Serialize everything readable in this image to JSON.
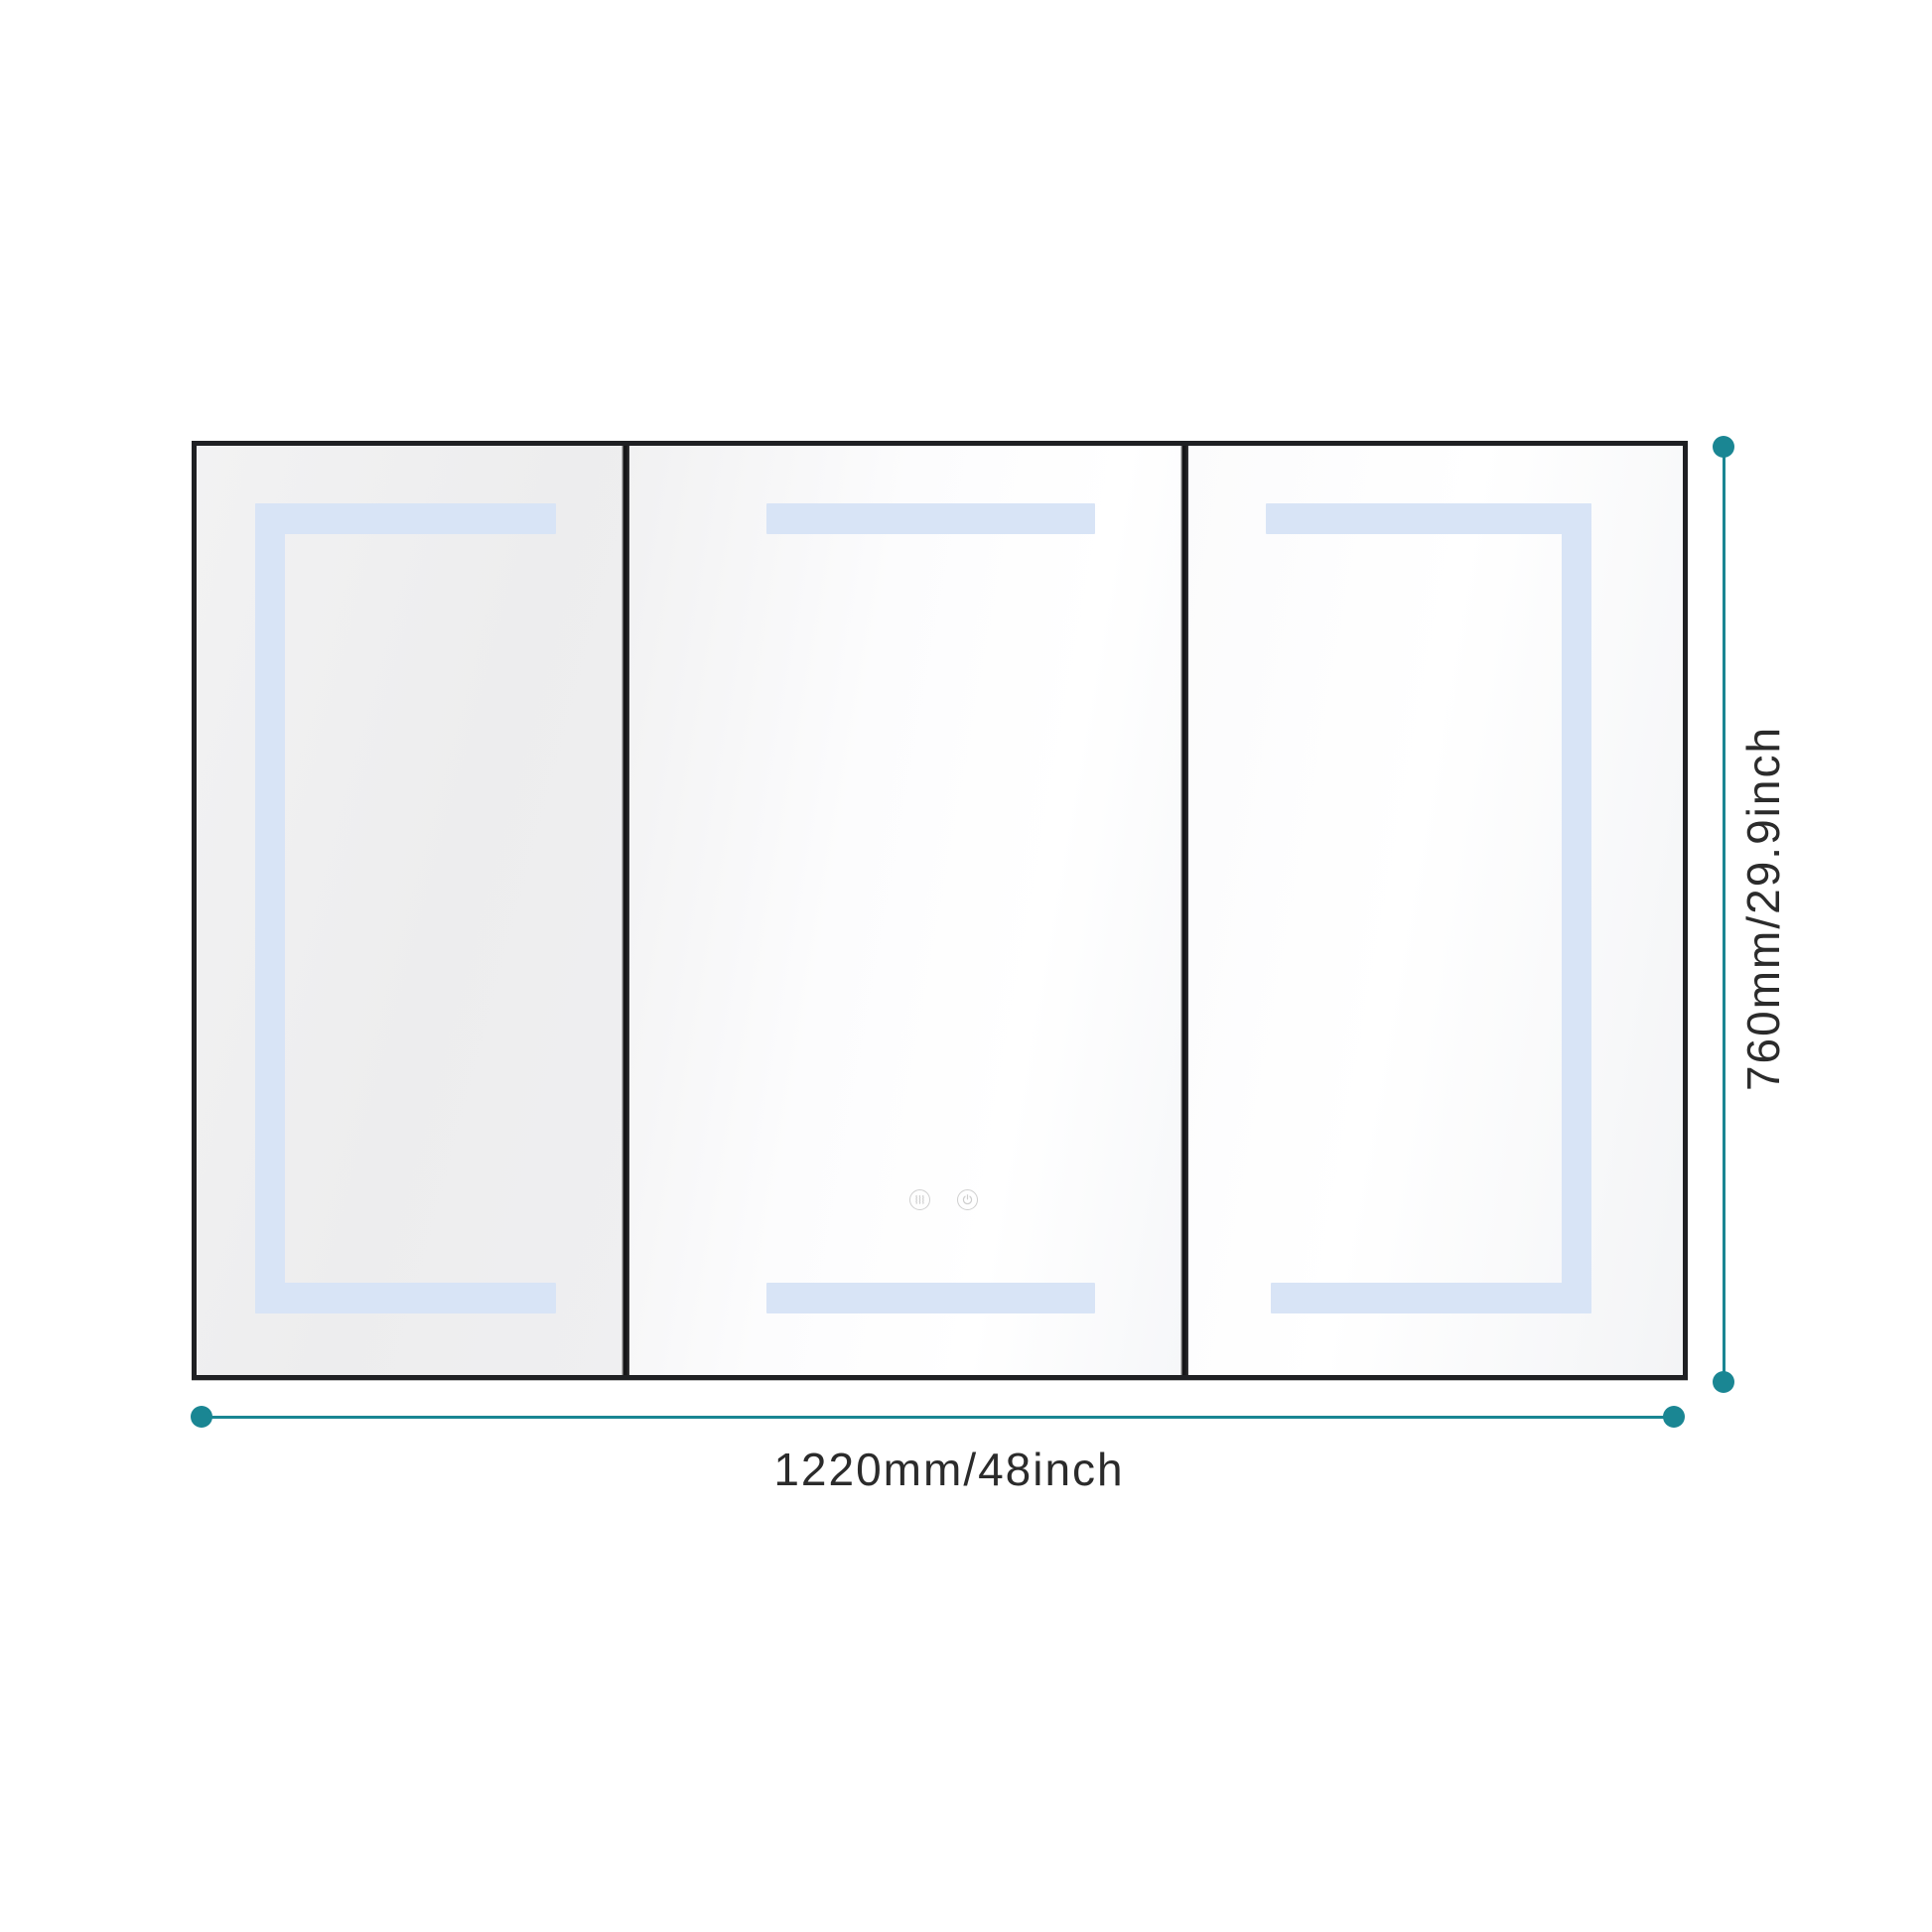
{
  "diagram": {
    "subject": "3-door LED mirror medicine cabinet - front dimension drawing",
    "panel_count": 3,
    "panels": [
      {
        "id": "left",
        "led_shape": "top-left-bottom frame"
      },
      {
        "id": "middle",
        "led_shape": "top and bottom bars",
        "controls": [
          "defog-button",
          "power-button"
        ]
      },
      {
        "id": "right",
        "led_shape": "top-right-bottom frame"
      }
    ]
  },
  "dimensions": {
    "width_label": "1220mm/48inch",
    "height_label": "760mm/29.9inch"
  },
  "icons": {
    "defog": "defog-steam-icon",
    "power": "power-icon"
  },
  "colors": {
    "accent": "#1a8693",
    "led": "#d8e4f6",
    "frame": "#1f2023",
    "text": "#2b2b2b",
    "button_stroke": "#cfcfcf",
    "background": "#ffffff"
  }
}
